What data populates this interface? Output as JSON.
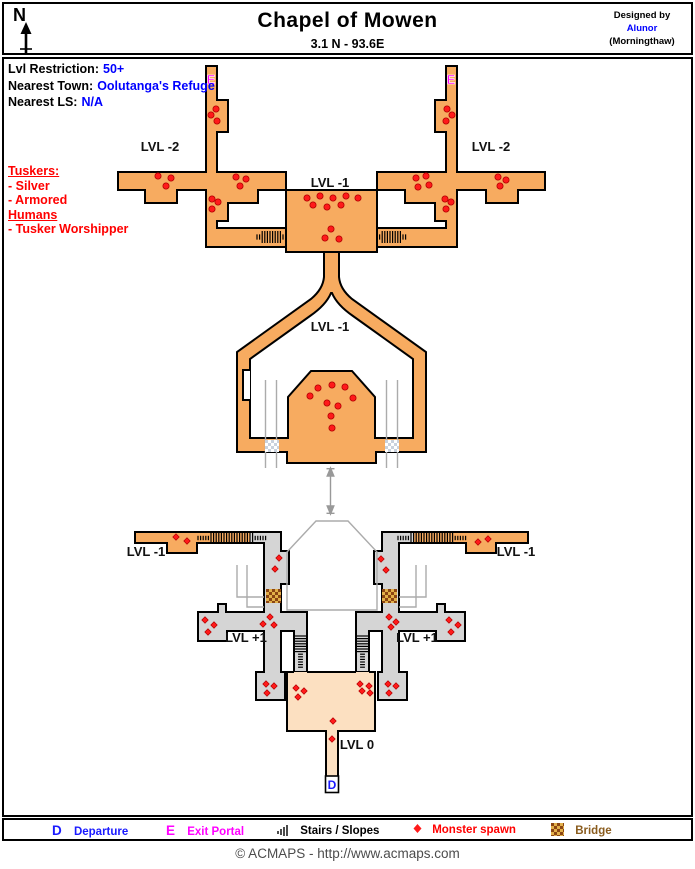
{
  "header": {
    "north_label": "N",
    "title": "Chapel of Mowen",
    "subtitle": "3.1 N - 93.6E",
    "designed_by": "Designed by",
    "designer_name": "Alunor",
    "designer_world": "(Morningthaw)"
  },
  "info": {
    "rows": [
      {
        "label": "Lvl Restriction:",
        "value": "50+"
      },
      {
        "label": "Nearest Town:",
        "value": "Oolutanga's Refuge"
      },
      {
        "label": "Nearest LS:",
        "value": "N/A"
      }
    ]
  },
  "monster_key": {
    "groups": [
      {
        "heading": "Tuskers:",
        "entries": [
          "- Silver",
          "- Armored"
        ]
      },
      {
        "heading": "Humans",
        "entries": [
          "- Tusker Worshipper"
        ]
      }
    ]
  },
  "map": {
    "labels": [
      {
        "text": "LVL -2",
        "x": 160,
        "y": 151
      },
      {
        "text": "LVL -2",
        "x": 491,
        "y": 151
      },
      {
        "text": "LVL -1",
        "x": 330,
        "y": 187
      },
      {
        "text": "LVL -1",
        "x": 330,
        "y": 331
      },
      {
        "text": "LVL -1",
        "x": 146,
        "y": 556
      },
      {
        "text": "LVL -1",
        "x": 516,
        "y": 556
      },
      {
        "text": "LVL +1",
        "x": 246,
        "y": 642
      },
      {
        "text": "LVL +1",
        "x": 417,
        "y": 642
      },
      {
        "text": "LVL 0",
        "x": 357,
        "y": 749
      }
    ],
    "exit_portals": [
      {
        "letter": "E",
        "x": 211,
        "y": 84
      },
      {
        "letter": "E",
        "x": 451,
        "y": 84
      }
    ],
    "departure": {
      "letter": "D",
      "x": 332,
      "y": 789
    },
    "spawn_points_upper": [
      [
        216,
        109
      ],
      [
        211,
        115
      ],
      [
        217,
        121
      ],
      [
        158,
        176
      ],
      [
        171,
        178
      ],
      [
        166,
        186
      ],
      [
        236,
        177
      ],
      [
        246,
        179
      ],
      [
        240,
        186
      ],
      [
        212,
        199
      ],
      [
        218,
        202
      ],
      [
        212,
        209
      ],
      [
        447,
        109
      ],
      [
        452,
        115
      ],
      [
        446,
        121
      ],
      [
        416,
        178
      ],
      [
        426,
        176
      ],
      [
        418,
        187
      ],
      [
        429,
        185
      ],
      [
        498,
        177
      ],
      [
        506,
        180
      ],
      [
        500,
        186
      ],
      [
        445,
        199
      ],
      [
        451,
        202
      ],
      [
        446,
        209
      ],
      [
        307,
        198
      ],
      [
        320,
        196
      ],
      [
        333,
        198
      ],
      [
        346,
        196
      ],
      [
        358,
        198
      ],
      [
        313,
        205
      ],
      [
        327,
        207
      ],
      [
        341,
        205
      ],
      [
        331,
        229
      ],
      [
        325,
        238
      ],
      [
        339,
        239
      ],
      [
        332,
        385
      ],
      [
        318,
        388
      ],
      [
        345,
        387
      ],
      [
        310,
        396
      ],
      [
        353,
        398
      ],
      [
        327,
        403
      ],
      [
        338,
        406
      ],
      [
        331,
        416
      ],
      [
        332,
        428
      ]
    ],
    "spawn_points_lower": [
      [
        176,
        537
      ],
      [
        187,
        541
      ],
      [
        478,
        542
      ],
      [
        488,
        539
      ],
      [
        279,
        558
      ],
      [
        275,
        569
      ],
      [
        381,
        559
      ],
      [
        386,
        570
      ],
      [
        270,
        617
      ],
      [
        263,
        624
      ],
      [
        274,
        625
      ],
      [
        389,
        617
      ],
      [
        396,
        622
      ],
      [
        391,
        627
      ],
      [
        205,
        620
      ],
      [
        214,
        625
      ],
      [
        208,
        632
      ],
      [
        449,
        620
      ],
      [
        458,
        625
      ],
      [
        451,
        632
      ],
      [
        266,
        684
      ],
      [
        274,
        686
      ],
      [
        267,
        693
      ],
      [
        388,
        684
      ],
      [
        396,
        686
      ],
      [
        389,
        693
      ],
      [
        296,
        688
      ],
      [
        304,
        691
      ],
      [
        298,
        697
      ],
      [
        360,
        684
      ],
      [
        369,
        686
      ],
      [
        362,
        691
      ],
      [
        370,
        693
      ],
      [
        333,
        721
      ],
      [
        332,
        739
      ]
    ]
  },
  "legend": {
    "items": [
      {
        "symbol": "D",
        "label": "Departure"
      },
      {
        "symbol": "E",
        "label": "Exit Portal"
      },
      {
        "symbol": "stairs-icon",
        "label": "Stairs / Slopes"
      },
      {
        "symbol": "monster-spawn-icon",
        "label": "Monster spawn"
      },
      {
        "symbol": "bridge-icon",
        "label": "Bridge"
      }
    ]
  },
  "footer": {
    "copyright": "© ACMAPS - http://www.acmaps.com"
  },
  "colors": {
    "corridor_orange": "#F7AB60",
    "room_peach": "#FCE0C1",
    "lower_gray": "#D5D5D5",
    "ghost_gray": "#ABABAB",
    "spawn_red": "#FF1A1A",
    "portal_magenta": "#FF00FF",
    "departure_blue": "#1A1AFF",
    "value_blue": "#0000FF",
    "key_red": "#FF0000",
    "bridge_brown": "#8B4513",
    "bridge_tan": "#E2B04A"
  }
}
